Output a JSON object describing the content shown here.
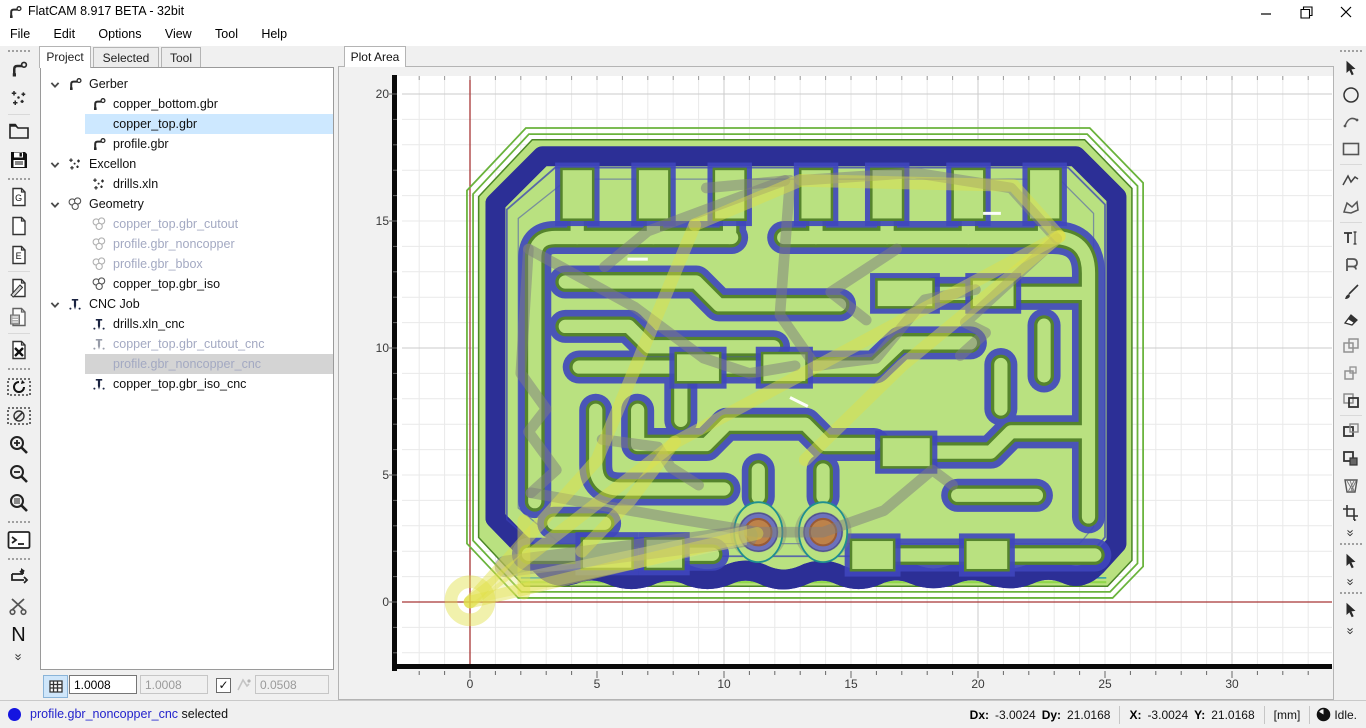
{
  "window": {
    "title": "FlatCAM 8.917 BETA - 32bit"
  },
  "menu": {
    "items": [
      "File",
      "Edit",
      "Options",
      "View",
      "Tool",
      "Help"
    ]
  },
  "left_tabs": {
    "items": [
      "Project",
      "Selected",
      "Tool"
    ],
    "active": "Project"
  },
  "plot_tab": {
    "label": "Plot Area"
  },
  "tree": {
    "groups": [
      "Gerber",
      "Excellon",
      "Geometry",
      "CNC Job"
    ],
    "items": [
      {
        "label": "Gerber"
      },
      {
        "label": "copper_bottom.gbr"
      },
      {
        "label": "copper_top.gbr",
        "selected": "blue"
      },
      {
        "label": "profile.gbr"
      },
      {
        "label": "Excellon"
      },
      {
        "label": "drills.xln"
      },
      {
        "label": "Geometry"
      },
      {
        "label": "copper_top.gbr_cutout",
        "state": "disabled"
      },
      {
        "label": "profile.gbr_noncopper",
        "state": "disabled"
      },
      {
        "label": "profile.gbr_bbox",
        "state": "disabled"
      },
      {
        "label": "copper_top.gbr_iso"
      },
      {
        "label": "CNC Job"
      },
      {
        "label": "drills.xln_cnc"
      },
      {
        "label": "copper_top.gbr_cutout_cnc",
        "state": "disabled"
      },
      {
        "label": "profile.gbr_noncopper_cnc",
        "state": "disabled",
        "selected": "gray"
      },
      {
        "label": "copper_top.gbr_iso_cnc"
      }
    ]
  },
  "grid_controls": {
    "grid_x": "1.0008",
    "grid_y": "1.0008",
    "snap_checked": "✓",
    "snap_max": "0.0508"
  },
  "left_toolbar": {
    "gerber_letter": "G",
    "excellon_letter": "E",
    "ncc_letter": "N",
    "tools": [
      "new-gerber",
      "new-excellon",
      "open-project",
      "save-project",
      "open-gerber",
      "new-file",
      "open-excellon",
      "edit-script",
      "save-object",
      "delete-object",
      "replot",
      "clear-plot",
      "zoom-in",
      "zoom-out",
      "zoom-fit",
      "command-line",
      "two-sided-tool",
      "cutout-tool",
      "ncc-tool"
    ]
  },
  "right_toolbar": {
    "tools": [
      "select",
      "circle",
      "arc",
      "rectangle",
      "polyline",
      "polygon",
      "text",
      "buffer",
      "paint",
      "eraser",
      "copy-objects",
      "copy-geometry",
      "union",
      "intersection",
      "subtract",
      "delete-shape",
      "transform",
      "select-gerber",
      "select-excellon"
    ]
  },
  "toolbar_misc": {
    "overflow_glyph": "»"
  },
  "plot": {
    "ox": 131,
    "oy": 535,
    "s": 25.4,
    "area": {
      "x1": 63,
      "y1": 9,
      "x2": 993,
      "y2": 599
    },
    "u_min": -2,
    "u_max": 34,
    "v_min": -2,
    "v_max": 23,
    "minor": "#e9e9e9",
    "major": "#cbcbcb",
    "x_tick_values": [
      0,
      5,
      10,
      15,
      20,
      25,
      30
    ],
    "x_ticks": [
      "0",
      "5",
      "10",
      "15",
      "20",
      "25",
      "30"
    ],
    "y_tick_values": [
      0,
      5,
      10,
      15,
      20
    ],
    "y_ticks": [
      "0",
      "5",
      "10",
      "15",
      "20"
    ]
  },
  "board_colors": {
    "substrate_green": "#b9e180",
    "green_edge": "#4c8726",
    "outline_green": "#6ab33c",
    "copper_blue": "#5a63de",
    "copper_edge": "#2c2f96",
    "drill_orange": "#e07d20",
    "drill_edge": "#a33c00",
    "crosshair_red": "#a83636"
  },
  "statusbar": {
    "selection": "profile.gbr_noncopper_cnc",
    "selection_suffix": "selected",
    "dx_label": "Dx:",
    "dx": "-3.0024",
    "dy_label": "Dy:",
    "dy": "21.0168",
    "x_label": "X:",
    "x": "-3.0024",
    "y_label": "Y:",
    "y": "21.0168",
    "units": "[mm]",
    "state": "Idle."
  }
}
